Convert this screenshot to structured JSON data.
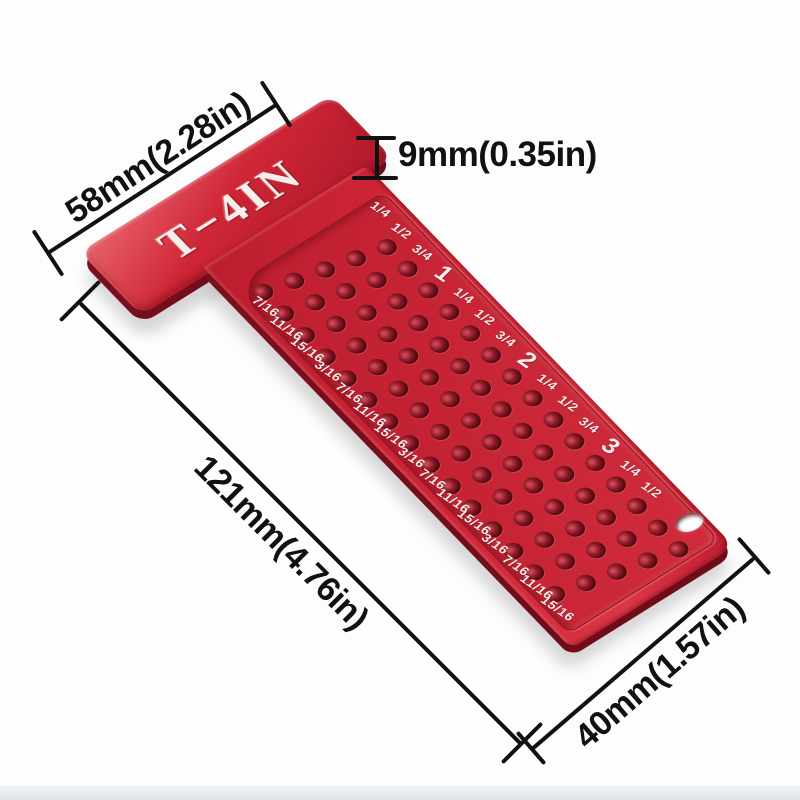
{
  "product": {
    "engraving": "T−4IN"
  },
  "annotations": {
    "head_width_label": "58mm(2.28in)",
    "thickness_label": "9mm(0.35in)",
    "total_length_label": "121mm(4.76in)",
    "blade_width_label": "40mm(1.57in)"
  },
  "tool": {
    "right_edge_labels": [
      "1/4",
      "1/2",
      "3/4",
      "1",
      "1/4",
      "1/2",
      "3/4",
      "2",
      "1/4",
      "1/2",
      "3/4",
      "3",
      "1/4",
      "1/2"
    ],
    "left_edge_labels": [
      "7/16",
      "11/16",
      "15/16",
      "3/16",
      "7/16",
      "11/16",
      "15/16",
      "3/16",
      "7/16",
      "11/16",
      "15/16",
      "3/16",
      "7/16",
      "11/16",
      "15/16"
    ],
    "hole_grid": {
      "rows": 15,
      "cols": 5
    }
  },
  "colors": {
    "body_red": "#cf2636",
    "side_red": "#7d0f1d",
    "hole_dark": "#4a070f",
    "engraving_white": "#f5eeea",
    "dimension_black": "#111111",
    "background": "#fdfdfd"
  }
}
